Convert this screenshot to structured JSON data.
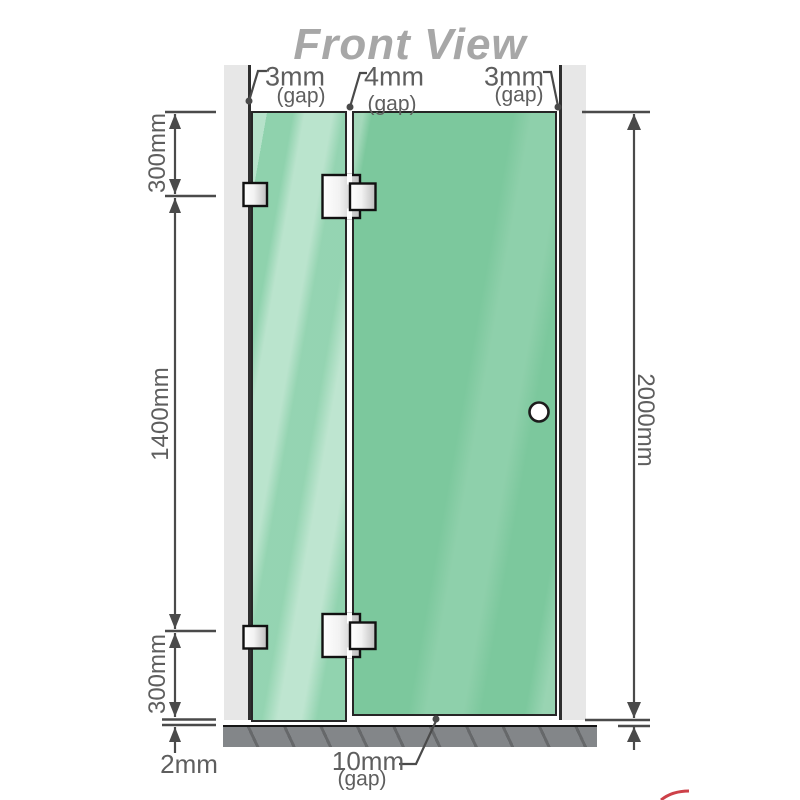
{
  "title": "Front View",
  "annotations": {
    "gap_left": {
      "value": "3mm",
      "unit": "(gap)"
    },
    "gap_middle": {
      "value": "4mm",
      "unit": "(gap)"
    },
    "gap_right": {
      "value": "3mm",
      "unit": "(gap)"
    },
    "gap_bottom": {
      "value": "10mm",
      "unit": "(gap)"
    }
  },
  "dimensions": {
    "left_top": "300mm",
    "left_middle": "1400mm",
    "left_bottom": "300mm",
    "floor_gap": "2mm",
    "right_height": "2000mm"
  },
  "colors": {
    "glass_green": "#7cc89d",
    "glass_highlight": "#b9e7cb",
    "wall_gray": "#e7e7e7",
    "floor_gray": "#838689",
    "dimension_line": "#4a4a4a",
    "title_gray": "#a7a7a7",
    "accent_red": "#c0111c"
  }
}
